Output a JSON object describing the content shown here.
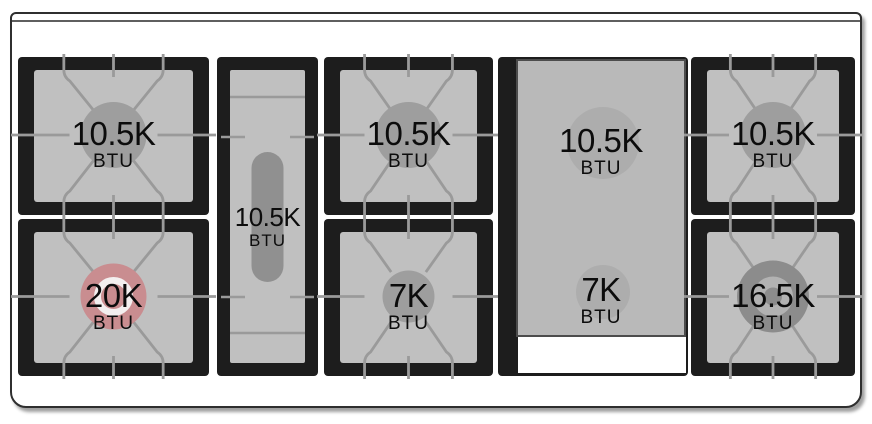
{
  "cooktop": {
    "unit_label": "BTU",
    "colors": {
      "frame_border": "#2f2f2f",
      "frame_inner_line": "#5f5f5f",
      "grate_black": "#1d1d1d",
      "panel_gray": "#c0c0c0",
      "line_gray": "#9a9a9a",
      "plate_gray": "#b9b9b9",
      "plate_burner_gray": "#adadad",
      "burner_gray": "#9e9e9e",
      "oval_burner_gray": "#909090",
      "power_burner_pink": "#c98d90",
      "power_burner_ring": "#f3efef",
      "dual_burner_gray": "#8c8c8c",
      "dual_burner_ring": "#b2b2b2",
      "text_black": "#0c0c0c",
      "griddle_opening_white": "#ffffff"
    },
    "burners": {
      "rear_left": {
        "label": "10.5K",
        "unit": "BTU",
        "type": "standard",
        "color": "#9e9e9e"
      },
      "front_left": {
        "label": "20K",
        "unit": "BTU",
        "type": "power",
        "color": "#c98d90",
        "ring": "#f3efef"
      },
      "center_oval": {
        "label": "10.5K",
        "unit": "BTU",
        "type": "oval",
        "color": "#909090"
      },
      "rear_center_left": {
        "label": "10.5K",
        "unit": "BTU",
        "type": "standard",
        "color": "#9e9e9e"
      },
      "front_center_left": {
        "label": "7K",
        "unit": "BTU",
        "type": "small",
        "color": "#9e9e9e"
      },
      "griddle_rear": {
        "label": "10.5K",
        "unit": "BTU",
        "type": "under-griddle",
        "color": "#adadad"
      },
      "griddle_front": {
        "label": "7K",
        "unit": "BTU",
        "type": "under-griddle",
        "color": "#adadad"
      },
      "rear_right": {
        "label": "10.5K",
        "unit": "BTU",
        "type": "standard",
        "color": "#9e9e9e"
      },
      "front_right": {
        "label": "16.5K",
        "unit": "BTU",
        "type": "dual",
        "color": "#8c8c8c",
        "ring": "#b2b2b2"
      }
    }
  }
}
